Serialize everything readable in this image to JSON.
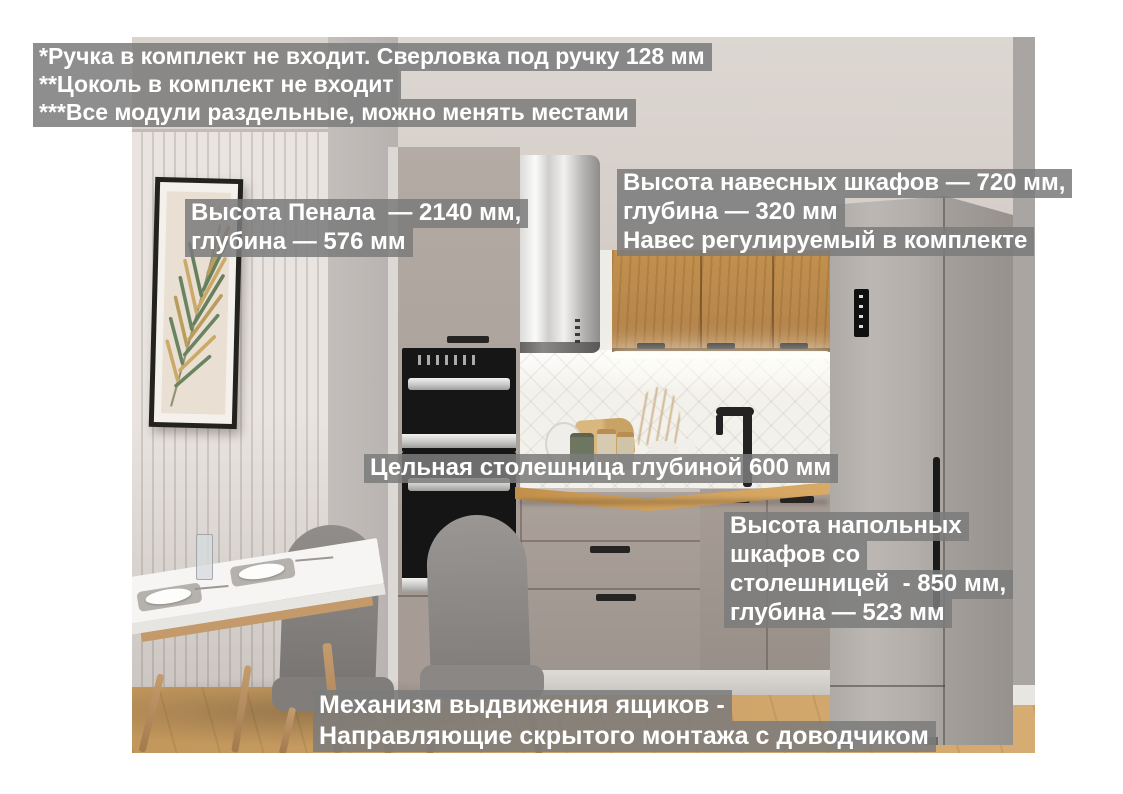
{
  "annotations": {
    "notes": [
      "*Ручка в комплект не входит. Сверловка под ручку 128 мм",
      "**Цоколь в комплект не входит",
      "***Все модули раздельные, можно менять местами"
    ],
    "pencil": [
      "Высота Пенала  — 2140 мм,",
      "глубина — 576 мм"
    ],
    "wall_cabinets": [
      "Высота навесных шкафов — 720 мм,",
      "глубина — 320 мм",
      "Навес регулируемый в комплекте"
    ],
    "countertop": [
      "Цельная столешница глубиной 600 мм"
    ],
    "base_cabinets": [
      "Высота напольных",
      "шкафов со",
      "столешницей  - 850 мм,",
      "глубина — 523 мм"
    ],
    "drawer_mechanism": [
      "Механизм выдвижения ящиков -",
      "Направляющие скрытого монтажа с доводчиком"
    ]
  },
  "colors": {
    "overlay_box": "#7c7c7c",
    "overlay_text": "#ffffff",
    "cabinet_taupe": "#a89e97",
    "wood_oak": "#bd8e4e",
    "countertop_oak": "#c9964f",
    "fridge_silver": "#b0aba7",
    "tile_white": "#f2f0ea",
    "floor_oak": "#cb9f64",
    "appliance_black": "#1b1b1b"
  }
}
